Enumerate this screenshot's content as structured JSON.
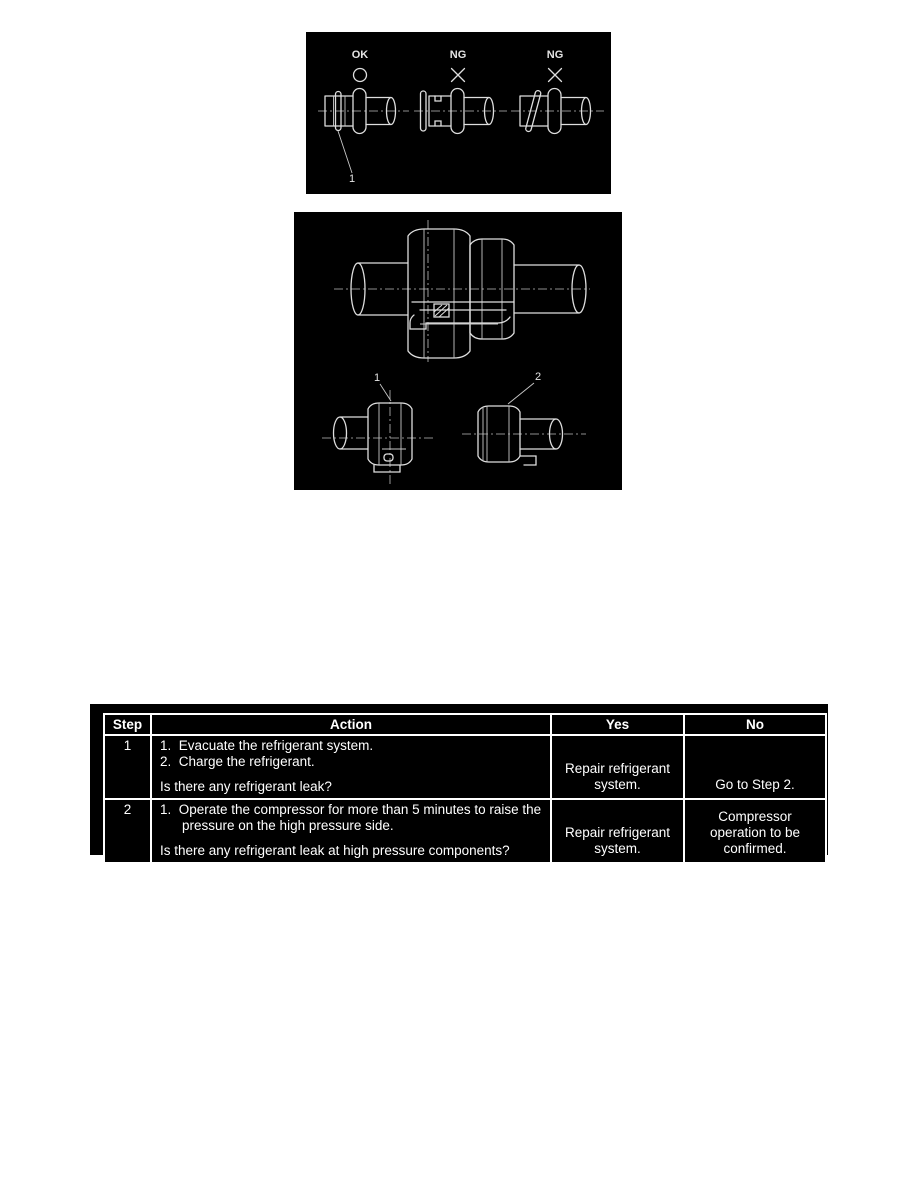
{
  "figure_oring": {
    "label_ok": "OK",
    "label_ng1": "NG",
    "label_ng2": "NG",
    "callout_oring": "1"
  },
  "figure_union": {
    "callout_nut": "1",
    "callout_fitting": "2"
  },
  "diagnostic_table": {
    "headers": {
      "step": "Step",
      "action": "Action",
      "yes": "Yes",
      "no": "No"
    },
    "rows": [
      {
        "step": "1",
        "actions": [
          "1.  Evacuate the refrigerant system.",
          "2.  Charge the refrigerant."
        ],
        "question": "Is there any refrigerant leak?",
        "yes": "Repair refrigerant system.",
        "no": "Go to Step 2."
      },
      {
        "step": "2",
        "actions": [
          "1.  Operate the compressor for more than 5 minutes to raise the pressure on the high pressure side."
        ],
        "question": "Is there any refrigerant leak at high pressure components?",
        "yes": "Repair refrigerant system.",
        "no": "Compressor operation to be confirmed."
      }
    ]
  },
  "colors": {
    "page_bg": "#ffffff",
    "panel_bg": "#000000",
    "art_line": "#dedede",
    "table_bg": "#000000",
    "table_border": "#ffffff",
    "table_text": "#ffffff"
  }
}
